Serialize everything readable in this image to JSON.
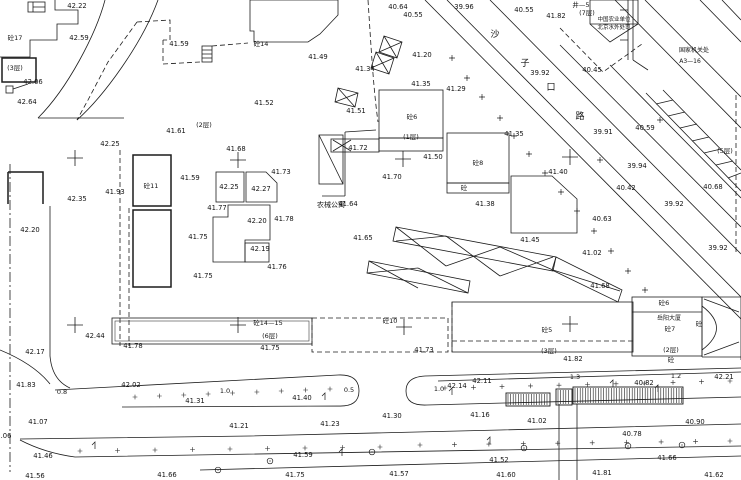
{
  "map": {
    "kind": "topographic survey site plan",
    "background_color": "#ffffff",
    "line_color": "#1c1c1c",
    "road_name_chars": [
      {
        "t": "沙",
        "x": 495,
        "y": 37
      },
      {
        "t": "子",
        "x": 525,
        "y": 66
      },
      {
        "t": "口",
        "x": 551,
        "y": 90
      },
      {
        "t": "路",
        "x": 580,
        "y": 119
      }
    ],
    "place_labels": [
      {
        "text": "农械公寓",
        "x": 331,
        "y": 207,
        "size": 7
      },
      {
        "text": "中国农业单位",
        "x": 614,
        "y": 21,
        "size": 5.5
      },
      {
        "text": "北京水外处司",
        "x": 614,
        "y": 29,
        "size": 5.5
      },
      {
        "text": "国家机关处",
        "x": 694,
        "y": 52,
        "size": 6
      },
      {
        "text": "A3—16",
        "x": 690,
        "y": 63,
        "size": 6
      },
      {
        "text": "岳阳大厦",
        "x": 669,
        "y": 320,
        "size": 6
      }
    ],
    "building_labels": [
      {
        "text": "砼17",
        "x": 15,
        "y": 40
      },
      {
        "text": "(3层)",
        "x": 15,
        "y": 70
      },
      {
        "text": "砼14",
        "x": 261,
        "y": 46
      },
      {
        "text": "(2层)",
        "x": 204,
        "y": 127
      },
      {
        "text": "砼11",
        "x": 151,
        "y": 188
      },
      {
        "text": "砼6",
        "x": 412,
        "y": 119
      },
      {
        "text": "(1层)",
        "x": 411,
        "y": 139
      },
      {
        "text": "砼8",
        "x": 478,
        "y": 165
      },
      {
        "text": "砼",
        "x": 464,
        "y": 190
      },
      {
        "text": "砼14—15",
        "x": 268,
        "y": 325
      },
      {
        "text": "(6层)",
        "x": 270,
        "y": 338
      },
      {
        "text": "砼10",
        "x": 390,
        "y": 323
      },
      {
        "text": "砼5",
        "x": 547,
        "y": 332
      },
      {
        "text": "(3层)",
        "x": 549,
        "y": 353
      },
      {
        "text": "砼6",
        "x": 664,
        "y": 305
      },
      {
        "text": "砼7",
        "x": 670,
        "y": 331
      },
      {
        "text": "(2层)",
        "x": 671,
        "y": 352
      },
      {
        "text": "砼",
        "x": 671,
        "y": 362
      },
      {
        "text": "砼",
        "x": 699,
        "y": 326
      },
      {
        "text": "井—5",
        "x": 581,
        "y": 7
      },
      {
        "text": "(7层)",
        "x": 587,
        "y": 15
      },
      {
        "text": "(5层)",
        "x": 725,
        "y": 153
      }
    ],
    "slope_labels": [
      {
        "text": "0.8",
        "x": 62,
        "y": 394
      },
      {
        "text": "1.0",
        "x": 225,
        "y": 393
      },
      {
        "text": "0.5",
        "x": 349,
        "y": 392
      },
      {
        "text": "1.0",
        "x": 439,
        "y": 391
      },
      {
        "text": "1.3",
        "x": 575,
        "y": 379
      },
      {
        "text": "1.2",
        "x": 676,
        "y": 378
      }
    ],
    "spot_elevations": [
      {
        "x": 77,
        "y": 8,
        "v": "42.22"
      },
      {
        "x": 79,
        "y": 40,
        "v": "42.59"
      },
      {
        "x": 33,
        "y": 84,
        "v": "42.06"
      },
      {
        "x": 27,
        "y": 104,
        "v": "42.64"
      },
      {
        "x": 110,
        "y": 146,
        "v": "42.25"
      },
      {
        "x": 115,
        "y": 194,
        "v": "41.93"
      },
      {
        "x": 77,
        "y": 201,
        "v": "42.35"
      },
      {
        "x": 30,
        "y": 232,
        "v": "42.20"
      },
      {
        "x": 95,
        "y": 338,
        "v": "42.44"
      },
      {
        "x": 35,
        "y": 354,
        "v": "42.17"
      },
      {
        "x": 26,
        "y": 387,
        "v": "41.83"
      },
      {
        "x": 38,
        "y": 424,
        "v": "41.07"
      },
      {
        "x": 43,
        "y": 458,
        "v": "41.46"
      },
      {
        "x": 35,
        "y": 478,
        "v": "41.56"
      },
      {
        "x": 179,
        "y": 46,
        "v": "41.59"
      },
      {
        "x": 176,
        "y": 133,
        "v": "41.61"
      },
      {
        "x": 318,
        "y": 59,
        "v": "41.49"
      },
      {
        "x": 264,
        "y": 105,
        "v": "41.52"
      },
      {
        "x": 356,
        "y": 113,
        "v": "41.51"
      },
      {
        "x": 236,
        "y": 151,
        "v": "41.68"
      },
      {
        "x": 190,
        "y": 180,
        "v": "41.59"
      },
      {
        "x": 229,
        "y": 189,
        "v": "42.25"
      },
      {
        "x": 261,
        "y": 191,
        "v": "42.27"
      },
      {
        "x": 281,
        "y": 174,
        "v": "41.73"
      },
      {
        "x": 217,
        "y": 210,
        "v": "41.77"
      },
      {
        "x": 257,
        "y": 223,
        "v": "42.20"
      },
      {
        "x": 284,
        "y": 221,
        "v": "41.78"
      },
      {
        "x": 198,
        "y": 239,
        "v": "41.75"
      },
      {
        "x": 260,
        "y": 251,
        "v": "42.19"
      },
      {
        "x": 277,
        "y": 269,
        "v": "41.76"
      },
      {
        "x": 203,
        "y": 278,
        "v": "41.75"
      },
      {
        "x": 358,
        "y": 150,
        "v": "41.72"
      },
      {
        "x": 392,
        "y": 179,
        "v": "41.70"
      },
      {
        "x": 348,
        "y": 206,
        "v": "41.64"
      },
      {
        "x": 363,
        "y": 240,
        "v": "41.65"
      },
      {
        "x": 398,
        "y": 9,
        "v": "40.64"
      },
      {
        "x": 413,
        "y": 17,
        "v": "40.55"
      },
      {
        "x": 464,
        "y": 9,
        "v": "39.96"
      },
      {
        "x": 365,
        "y": 71,
        "v": "41.34"
      },
      {
        "x": 422,
        "y": 57,
        "v": "41.20"
      },
      {
        "x": 421,
        "y": 86,
        "v": "41.35"
      },
      {
        "x": 456,
        "y": 91,
        "v": "41.29"
      },
      {
        "x": 524,
        "y": 12,
        "v": "40.55"
      },
      {
        "x": 556,
        "y": 18,
        "v": "41.82"
      },
      {
        "x": 540,
        "y": 75,
        "v": "39.92"
      },
      {
        "x": 592,
        "y": 72,
        "v": "40.45"
      },
      {
        "x": 433,
        "y": 159,
        "v": "41.50"
      },
      {
        "x": 514,
        "y": 136,
        "v": "41.35"
      },
      {
        "x": 603,
        "y": 134,
        "v": "39.91"
      },
      {
        "x": 637,
        "y": 168,
        "v": "39.94"
      },
      {
        "x": 645,
        "y": 130,
        "v": "40.59"
      },
      {
        "x": 558,
        "y": 174,
        "v": "41.40"
      },
      {
        "x": 485,
        "y": 206,
        "v": "41.38"
      },
      {
        "x": 530,
        "y": 242,
        "v": "41.45"
      },
      {
        "x": 626,
        "y": 190,
        "v": "40.42"
      },
      {
        "x": 602,
        "y": 221,
        "v": "40.63"
      },
      {
        "x": 713,
        "y": 189,
        "v": "40.68"
      },
      {
        "x": 674,
        "y": 206,
        "v": "39.92"
      },
      {
        "x": 718,
        "y": 250,
        "v": "39.92"
      },
      {
        "x": 592,
        "y": 255,
        "v": "41.02"
      },
      {
        "x": 600,
        "y": 288,
        "v": "41.68"
      },
      {
        "x": 133,
        "y": 348,
        "v": "41.78"
      },
      {
        "x": 270,
        "y": 350,
        "v": "41.75"
      },
      {
        "x": 424,
        "y": 352,
        "v": "41.73"
      },
      {
        "x": 573,
        "y": 361,
        "v": "41.82"
      },
      {
        "x": 724,
        "y": 379,
        "v": "42.21"
      },
      {
        "x": 131,
        "y": 387,
        "v": "42.02"
      },
      {
        "x": 195,
        "y": 403,
        "v": "41.31"
      },
      {
        "x": 302,
        "y": 400,
        "v": "41.40"
      },
      {
        "x": 457,
        "y": 388,
        "v": "42.14"
      },
      {
        "x": 482,
        "y": 383,
        "v": "42.11"
      },
      {
        "x": 644,
        "y": 385,
        "v": "40.82"
      },
      {
        "x": 392,
        "y": 418,
        "v": "41.30"
      },
      {
        "x": 480,
        "y": 417,
        "v": "41.16"
      },
      {
        "x": 239,
        "y": 428,
        "v": "41.21"
      },
      {
        "x": 330,
        "y": 426,
        "v": "41.23"
      },
      {
        "x": 537,
        "y": 423,
        "v": "41.02"
      },
      {
        "x": 695,
        "y": 424,
        "v": "40.90"
      },
      {
        "x": 632,
        "y": 436,
        "v": "40.78"
      },
      {
        "x": 6,
        "y": 438,
        "v": ".06"
      },
      {
        "x": 499,
        "y": 462,
        "v": "41.52"
      },
      {
        "x": 667,
        "y": 460,
        "v": "41.66"
      },
      {
        "x": 303,
        "y": 457,
        "v": "41.59"
      },
      {
        "x": 167,
        "y": 477,
        "v": "41.66"
      },
      {
        "x": 295,
        "y": 477,
        "v": "41.75"
      },
      {
        "x": 399,
        "y": 476,
        "v": "41.57"
      },
      {
        "x": 506,
        "y": 477,
        "v": "41.60"
      },
      {
        "x": 602,
        "y": 475,
        "v": "41.81"
      },
      {
        "x": 714,
        "y": 477,
        "v": "41.62"
      }
    ],
    "grid_crosses": [
      [
        75,
        158
      ],
      [
        238,
        160
      ],
      [
        403,
        159
      ],
      [
        570,
        157
      ],
      [
        75,
        325
      ],
      [
        238,
        325
      ],
      [
        404,
        327
      ],
      [
        570,
        324
      ]
    ],
    "tree_marks": [
      [
        500,
        118
      ],
      [
        514,
        136
      ],
      [
        529,
        154
      ],
      [
        545,
        173
      ],
      [
        561,
        192
      ],
      [
        577,
        211
      ],
      [
        594,
        231
      ],
      [
        611,
        251
      ],
      [
        628,
        271
      ],
      [
        645,
        290
      ],
      [
        452,
        58
      ],
      [
        467,
        78
      ],
      [
        482,
        97
      ],
      [
        660,
        120
      ],
      [
        600,
        160
      ]
    ],
    "tree_circles": [
      [
        218,
        470
      ],
      [
        270,
        461
      ],
      [
        372,
        452
      ],
      [
        524,
        448
      ],
      [
        628,
        446
      ],
      [
        682,
        445
      ]
    ],
    "lamp_marks": [
      [
        325,
        400
      ],
      [
        452,
        395
      ],
      [
        613,
        387
      ],
      [
        658,
        392
      ],
      [
        95,
        449
      ],
      [
        342,
        456
      ],
      [
        490,
        444
      ]
    ],
    "tick_rows": [
      {
        "x0": 135,
        "x1": 330,
        "n": 9,
        "y0": 397,
        "y1": 389
      },
      {
        "x0": 445,
        "x1": 730,
        "n": 11,
        "y0": 388,
        "y1": 381
      },
      {
        "x0": 80,
        "x1": 380,
        "n": 9,
        "y0": 451,
        "y1": 447
      },
      {
        "x0": 420,
        "x1": 730,
        "n": 10,
        "y0": 445,
        "y1": 441
      }
    ],
    "hatch_boxes": [
      {
        "x": 506,
        "y": 393,
        "w": 44,
        "h": 13
      },
      {
        "x": 556,
        "y": 389,
        "w": 16,
        "h": 16
      },
      {
        "x": 573,
        "y": 387,
        "w": 110,
        "h": 17
      }
    ]
  }
}
